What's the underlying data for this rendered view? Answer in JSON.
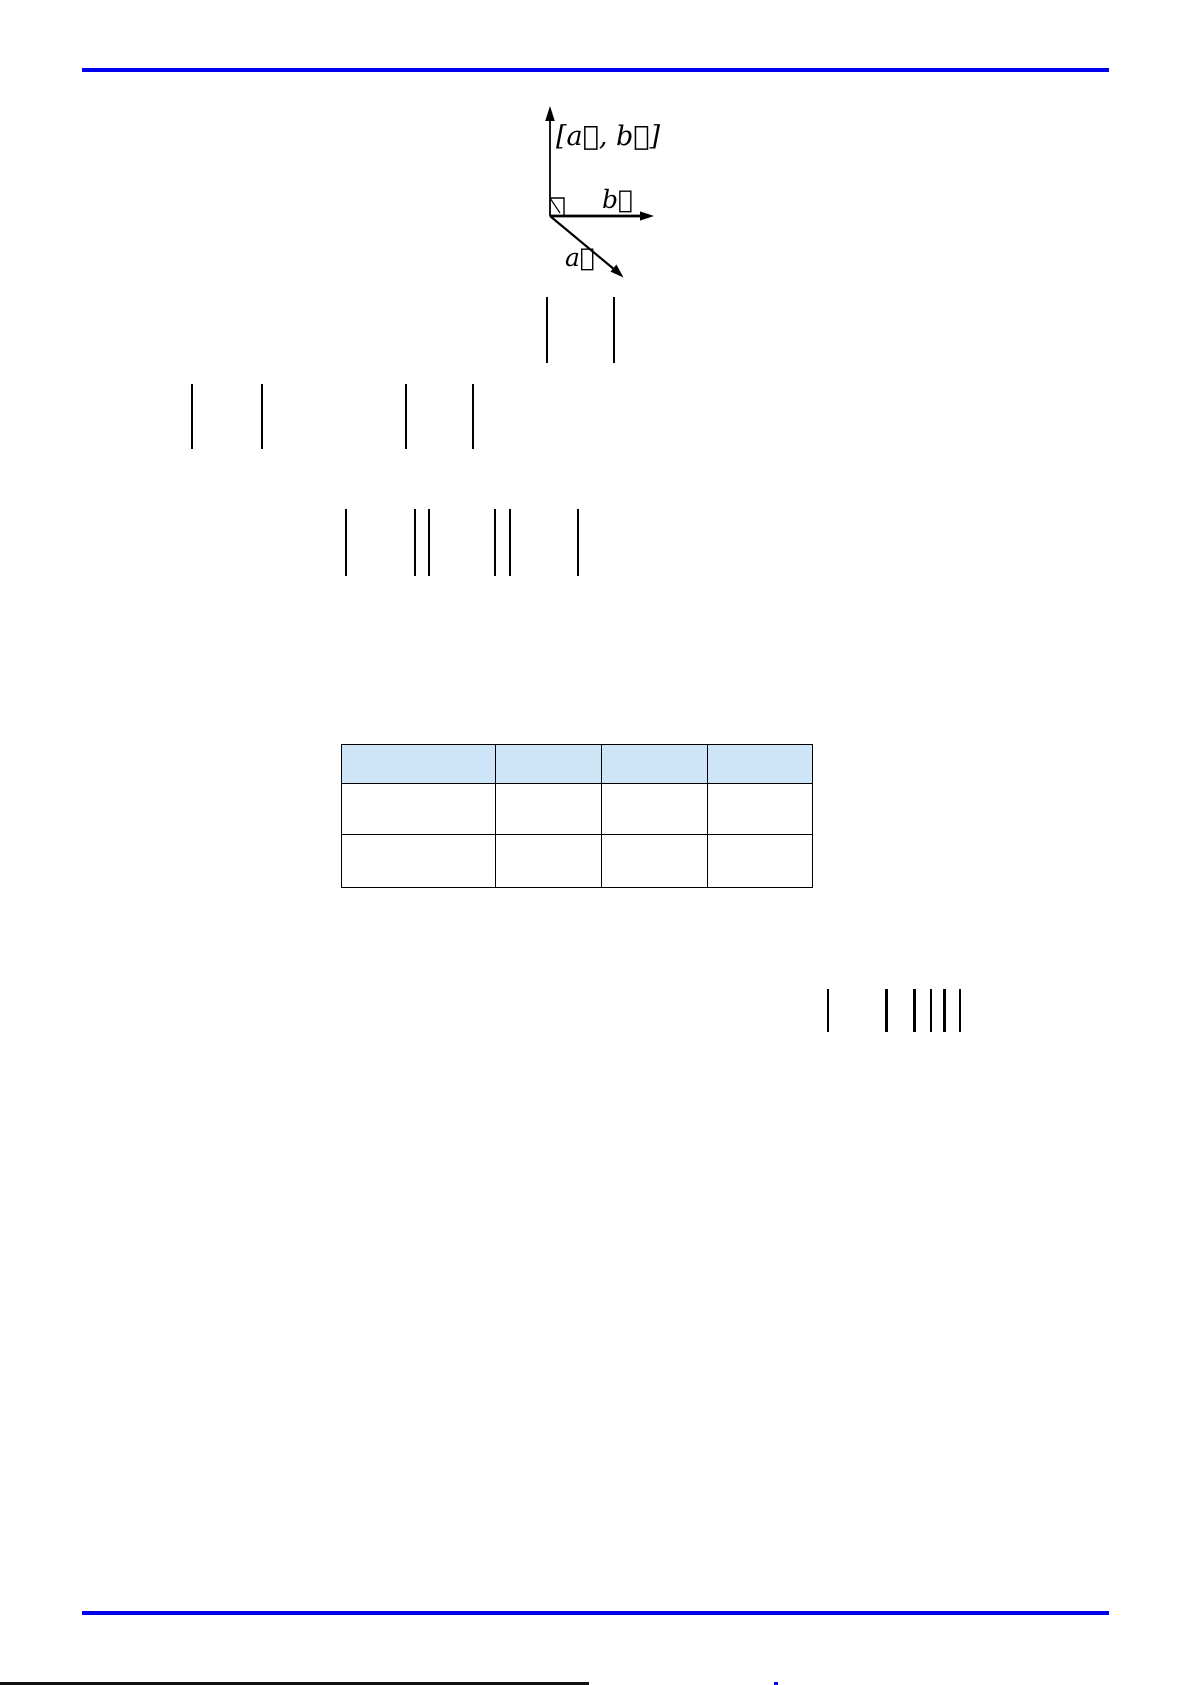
{
  "page": {
    "width": 1191,
    "height": 1685,
    "background": "#ffffff"
  },
  "rules": {
    "color": "#0000ee",
    "header": {
      "x": 82,
      "y": 68,
      "width": 1027,
      "thickness": 4
    },
    "footer": {
      "x": 82,
      "y": 1611,
      "width": 1027,
      "thickness": 4
    }
  },
  "diagram": {
    "name": "cross-product-of-two-vectors",
    "labels": {
      "cross_product": "[a⃗, b⃗]",
      "vector_b": "b⃗",
      "vector_a": "a⃗"
    }
  },
  "formula_bars": {
    "color": "#000000",
    "groups": [
      {
        "name": "line1",
        "top": 297,
        "height": 66,
        "bars": [
          {
            "x": 546,
            "w": 2
          },
          {
            "x": 613,
            "w": 2
          }
        ]
      },
      {
        "name": "line2",
        "top": 384,
        "height": 65,
        "bars": [
          {
            "x": 191,
            "w": 2
          },
          {
            "x": 261,
            "w": 2
          },
          {
            "x": 405,
            "w": 2
          },
          {
            "x": 472,
            "w": 2
          }
        ]
      },
      {
        "name": "line3",
        "top": 509,
        "height": 67,
        "bars": [
          {
            "x": 345,
            "w": 2
          },
          {
            "x": 414,
            "w": 2
          },
          {
            "x": 428,
            "w": 2
          },
          {
            "x": 494,
            "w": 2
          },
          {
            "x": 509,
            "w": 2
          },
          {
            "x": 577,
            "w": 2
          }
        ]
      },
      {
        "name": "line4",
        "top": 989,
        "height": 43,
        "bars": [
          {
            "x": 827,
            "w": 1.5
          },
          {
            "x": 885,
            "w": 2.5
          },
          {
            "x": 913,
            "w": 2.5
          },
          {
            "x": 930,
            "w": 1.5
          },
          {
            "x": 943,
            "w": 2.5
          },
          {
            "x": 959,
            "w": 1.5
          }
        ]
      }
    ]
  },
  "table": {
    "x": 341,
    "y": 744,
    "width": 471,
    "header_fill": "#cee5f8",
    "border_color": "#000000",
    "column_widths": [
      154,
      106,
      106,
      105
    ],
    "header_height": 39,
    "row_heights": [
      51,
      53
    ],
    "headers": [
      "",
      "",
      "",
      ""
    ],
    "rows": [
      [
        "",
        "",
        "",
        ""
      ],
      [
        "",
        "",
        "",
        ""
      ]
    ]
  },
  "bottom_artifacts": {
    "black_line": {
      "x": 0,
      "y": 1682,
      "width": 589,
      "thickness": 3,
      "color": "#111111"
    },
    "blue_mark": {
      "x": 774,
      "y": 1682,
      "width": 4,
      "thickness": 3,
      "color": "#0000ee"
    }
  }
}
